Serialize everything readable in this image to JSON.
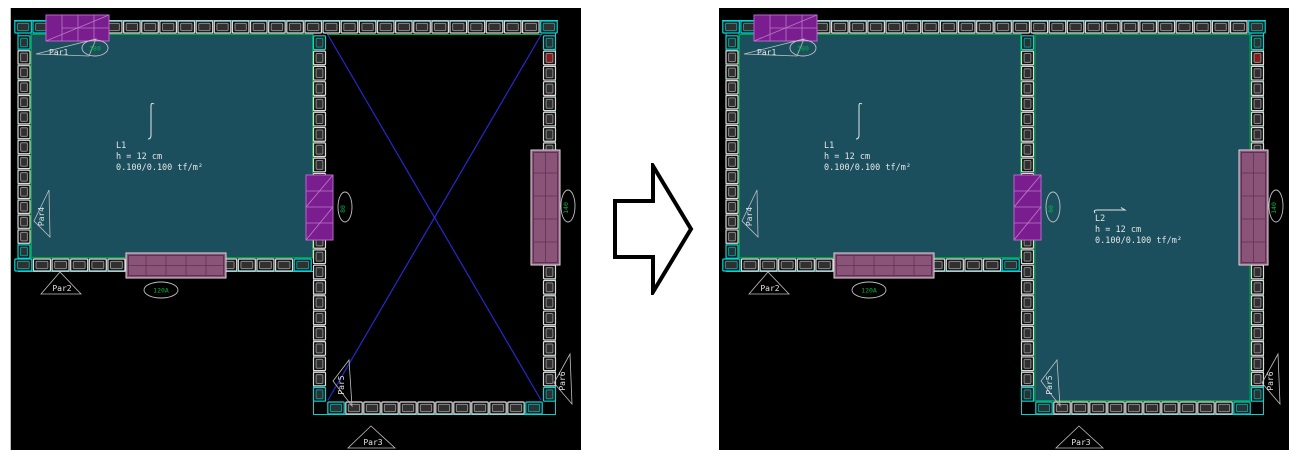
{
  "wall_labels": {
    "par1": "Par1",
    "par2": "Par2",
    "par3": "Par3",
    "par4": "Par4",
    "par5": "Par5",
    "par6": "Par6"
  },
  "opening_tags": {
    "top_window": "380",
    "interior_door": "80",
    "bottom_window": "120A",
    "right_window": "140"
  },
  "slabs": {
    "l1": {
      "name": "L1",
      "thickness": "h = 12 cm",
      "load": "0.100/0.100 tf/m²"
    },
    "l2": {
      "name": "L2",
      "thickness": "h = 12 cm",
      "load": "0.100/0.100 tf/m²"
    }
  },
  "colors": {
    "panel_bg": "#000000",
    "slab_fill": "#1b4f5e",
    "slab_edge_green": "#00a432",
    "outer_edge_cyan": "#00d2d2",
    "block_outline": "#dcdcdc",
    "block_inner": "#8a8a8a",
    "block_fill": "#111111",
    "block_cell": "#303030",
    "corner_highlight": "#00d8d8",
    "opening_vivid": "#7a1d8e",
    "opening_vivid_line": "#b878c8",
    "opening_muted": "#8a5479",
    "opening_muted_line": "#5f3154",
    "cross_blue": "#2828cc",
    "marker_red": "#8c1a1a",
    "label_text": "#e6e6e6",
    "tag_text": "#00b43c",
    "marker_stroke": "#c0c0c0"
  }
}
